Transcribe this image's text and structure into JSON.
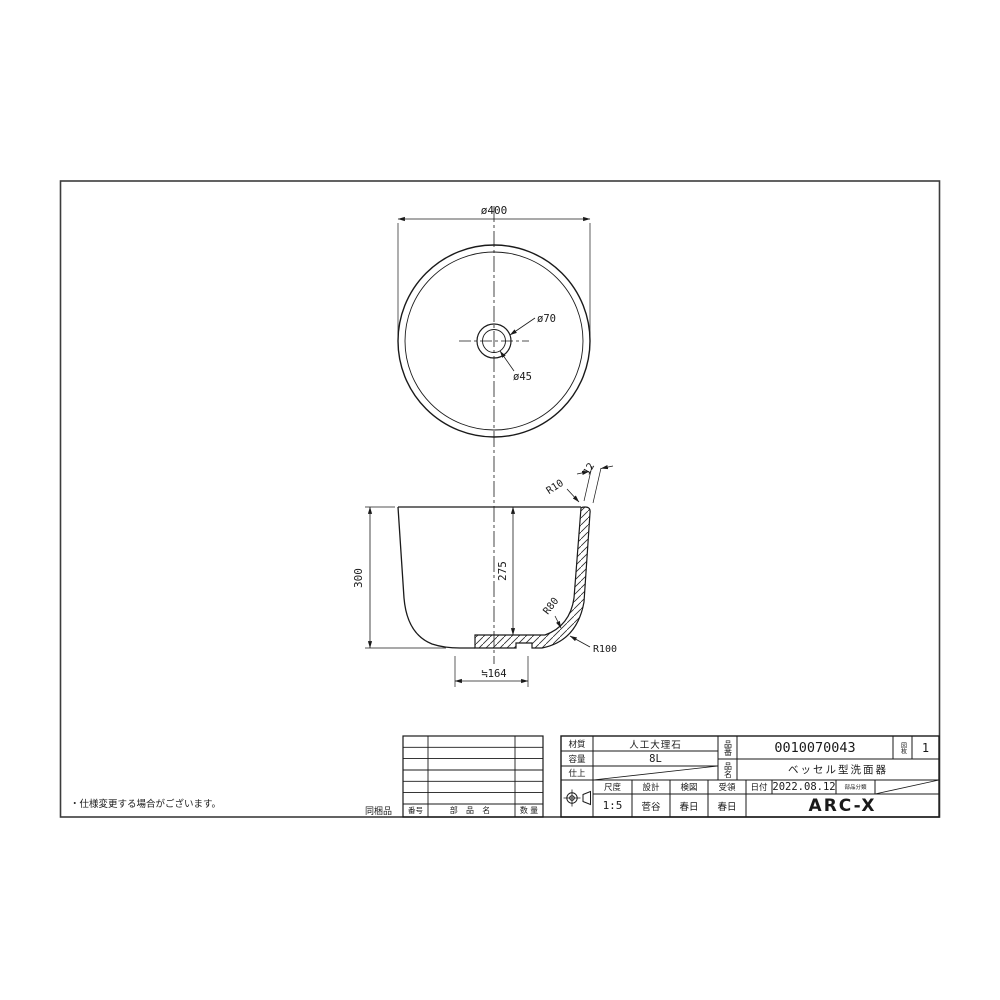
{
  "note": "・仕様変更する場合がございます。",
  "top_view": {
    "dim_diameter": "ø400",
    "dim_drain_outer": "ø70",
    "dim_drain_inner": "ø45"
  },
  "section_view": {
    "dim_height": "300",
    "dim_depth": "275",
    "dim_thickness": "12",
    "r_rim": "R10",
    "r_inner": "R80",
    "r_outer": "R100",
    "dim_bottom": "≒164"
  },
  "parts_table": {
    "side_label": "同梱品",
    "col_no": "番号",
    "col_name": "部 品 名",
    "col_qty": "数 量"
  },
  "title_block": {
    "material_label": "材質",
    "material_value": "人工大理石",
    "capacity_label": "容量",
    "capacity_value": "8L",
    "finish_label": "仕上",
    "part_no_label": "品番",
    "part_no_value": "0010070043",
    "sheets_label": "図枚",
    "sheets_value": "1",
    "product_label": "品名",
    "product_value": "ベッセル型洗面器",
    "scale_label": "尺度",
    "scale_value": "1:5",
    "design_label": "設計",
    "design_value": "菅谷",
    "check_label": "検図",
    "check_value": "春日",
    "receipt_label": "受領",
    "receipt_value": "春日",
    "date_label": "日付",
    "date_value": "2022.08.12",
    "category_label": "部品分類",
    "company": "ARC-X"
  }
}
